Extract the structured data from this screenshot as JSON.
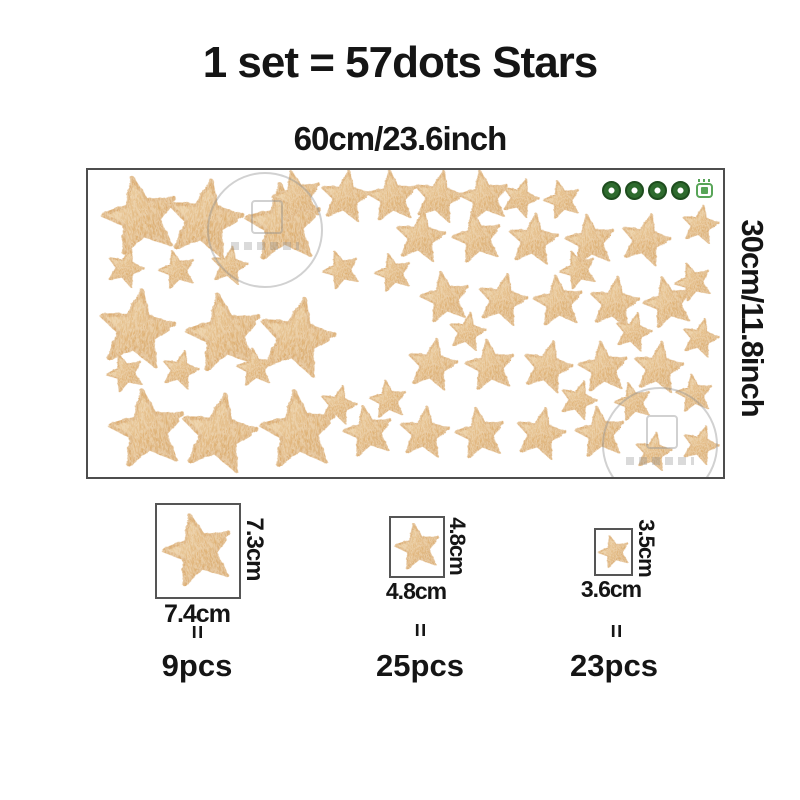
{
  "title": "1 set = 57dots Stars",
  "sheet": {
    "width_label": "60cm/23.6inch",
    "height_label": "30cm/11.8inch",
    "badge_icons": [
      "eco-round-stamp-icon",
      "eco-round-stamp-icon",
      "eco-round-stamp-icon",
      "eco-round-stamp-icon",
      "eco-seal-icon"
    ],
    "star_px": {
      "L": 78,
      "M": 51,
      "S": 38
    },
    "stars": [
      {
        "x": 52,
        "y": 47,
        "s": "L",
        "r": -12
      },
      {
        "x": 116,
        "y": 50,
        "s": "L",
        "r": 10
      },
      {
        "x": 195,
        "y": 54,
        "s": "L",
        "r": -5
      },
      {
        "x": 48,
        "y": 160,
        "s": "L",
        "r": 8
      },
      {
        "x": 136,
        "y": 164,
        "s": "L",
        "r": -10
      },
      {
        "x": 208,
        "y": 168,
        "s": "L",
        "r": 12
      },
      {
        "x": 59,
        "y": 260,
        "s": "L",
        "r": -8
      },
      {
        "x": 130,
        "y": 264,
        "s": "L",
        "r": 10
      },
      {
        "x": 210,
        "y": 261,
        "s": "L",
        "r": -6
      },
      {
        "x": 209,
        "y": 27,
        "s": "M",
        "r": -14
      },
      {
        "x": 257,
        "y": 27,
        "s": "M",
        "r": 8
      },
      {
        "x": 304,
        "y": 27,
        "s": "M",
        "r": -6
      },
      {
        "x": 350,
        "y": 27,
        "s": "M",
        "r": 12
      },
      {
        "x": 396,
        "y": 27,
        "s": "M",
        "r": -10
      },
      {
        "x": 332,
        "y": 67,
        "s": "M",
        "r": 8
      },
      {
        "x": 389,
        "y": 68,
        "s": "M",
        "r": -12
      },
      {
        "x": 445,
        "y": 70,
        "s": "M",
        "r": 6
      },
      {
        "x": 502,
        "y": 71,
        "s": "M",
        "r": -8
      },
      {
        "x": 557,
        "y": 70,
        "s": "M",
        "r": 14
      },
      {
        "x": 357,
        "y": 128,
        "s": "M",
        "r": -10
      },
      {
        "x": 414,
        "y": 130,
        "s": "M",
        "r": 12
      },
      {
        "x": 470,
        "y": 132,
        "s": "M",
        "r": -6
      },
      {
        "x": 526,
        "y": 133,
        "s": "M",
        "r": 8
      },
      {
        "x": 580,
        "y": 133,
        "s": "M",
        "r": -14
      },
      {
        "x": 344,
        "y": 195,
        "s": "M",
        "r": 10
      },
      {
        "x": 402,
        "y": 196,
        "s": "M",
        "r": -8
      },
      {
        "x": 459,
        "y": 197,
        "s": "M",
        "r": 14
      },
      {
        "x": 515,
        "y": 198,
        "s": "M",
        "r": -6
      },
      {
        "x": 570,
        "y": 198,
        "s": "M",
        "r": 8
      },
      {
        "x": 280,
        "y": 262,
        "s": "M",
        "r": -12
      },
      {
        "x": 336,
        "y": 263,
        "s": "M",
        "r": 6
      },
      {
        "x": 392,
        "y": 264,
        "s": "M",
        "r": -10
      },
      {
        "x": 452,
        "y": 264,
        "s": "M",
        "r": 12
      },
      {
        "x": 512,
        "y": 263,
        "s": "M",
        "r": -8
      },
      {
        "x": 37,
        "y": 98,
        "s": "S",
        "r": 18
      },
      {
        "x": 89,
        "y": 100,
        "s": "S",
        "r": -15
      },
      {
        "x": 141,
        "y": 96,
        "s": "S",
        "r": 10
      },
      {
        "x": 37,
        "y": 203,
        "s": "S",
        "r": -20
      },
      {
        "x": 92,
        "y": 200,
        "s": "S",
        "r": 14
      },
      {
        "x": 167,
        "y": 198,
        "s": "S",
        "r": -8
      },
      {
        "x": 432,
        "y": 28,
        "s": "S",
        "r": 18
      },
      {
        "x": 474,
        "y": 30,
        "s": "S",
        "r": -15
      },
      {
        "x": 612,
        "y": 55,
        "s": "S",
        "r": 10
      },
      {
        "x": 605,
        "y": 112,
        "s": "S",
        "r": -20
      },
      {
        "x": 612,
        "y": 168,
        "s": "S",
        "r": 14
      },
      {
        "x": 606,
        "y": 224,
        "s": "S",
        "r": -8
      },
      {
        "x": 612,
        "y": 275,
        "s": "S",
        "r": 18
      },
      {
        "x": 305,
        "y": 103,
        "s": "S",
        "r": -15
      },
      {
        "x": 379,
        "y": 162,
        "s": "S",
        "r": 10
      },
      {
        "x": 490,
        "y": 100,
        "s": "S",
        "r": -20
      },
      {
        "x": 545,
        "y": 162,
        "s": "S",
        "r": 14
      },
      {
        "x": 300,
        "y": 230,
        "s": "S",
        "r": -8
      },
      {
        "x": 490,
        "y": 230,
        "s": "S",
        "r": 18
      },
      {
        "x": 545,
        "y": 232,
        "s": "S",
        "r": -15
      },
      {
        "x": 565,
        "y": 282,
        "s": "S",
        "r": 10
      },
      {
        "x": 253,
        "y": 100,
        "s": "S",
        "r": -20
      },
      {
        "x": 250,
        "y": 235,
        "s": "S",
        "r": 14
      }
    ]
  },
  "sizes": [
    {
      "width_label": "7.4cm",
      "height_label": "7.3cm",
      "equals": "=",
      "count": "9pcs"
    },
    {
      "width_label": "4.8cm",
      "height_label": "4.8cm",
      "equals": "=",
      "count": "25pcs"
    },
    {
      "width_label": "3.6cm",
      "height_label": "3.5cm",
      "equals": "=",
      "count": "23pcs"
    }
  ],
  "colors": {
    "text": "#151515",
    "border": "#4d4d4d",
    "star_light": "#f0d9b0",
    "star_mid": "#e2b77d",
    "star_dark": "#d3a05e",
    "star_stroke": "#dcae74",
    "badge_green": "#2e6b2e",
    "badge_light_green": "#58a558"
  }
}
